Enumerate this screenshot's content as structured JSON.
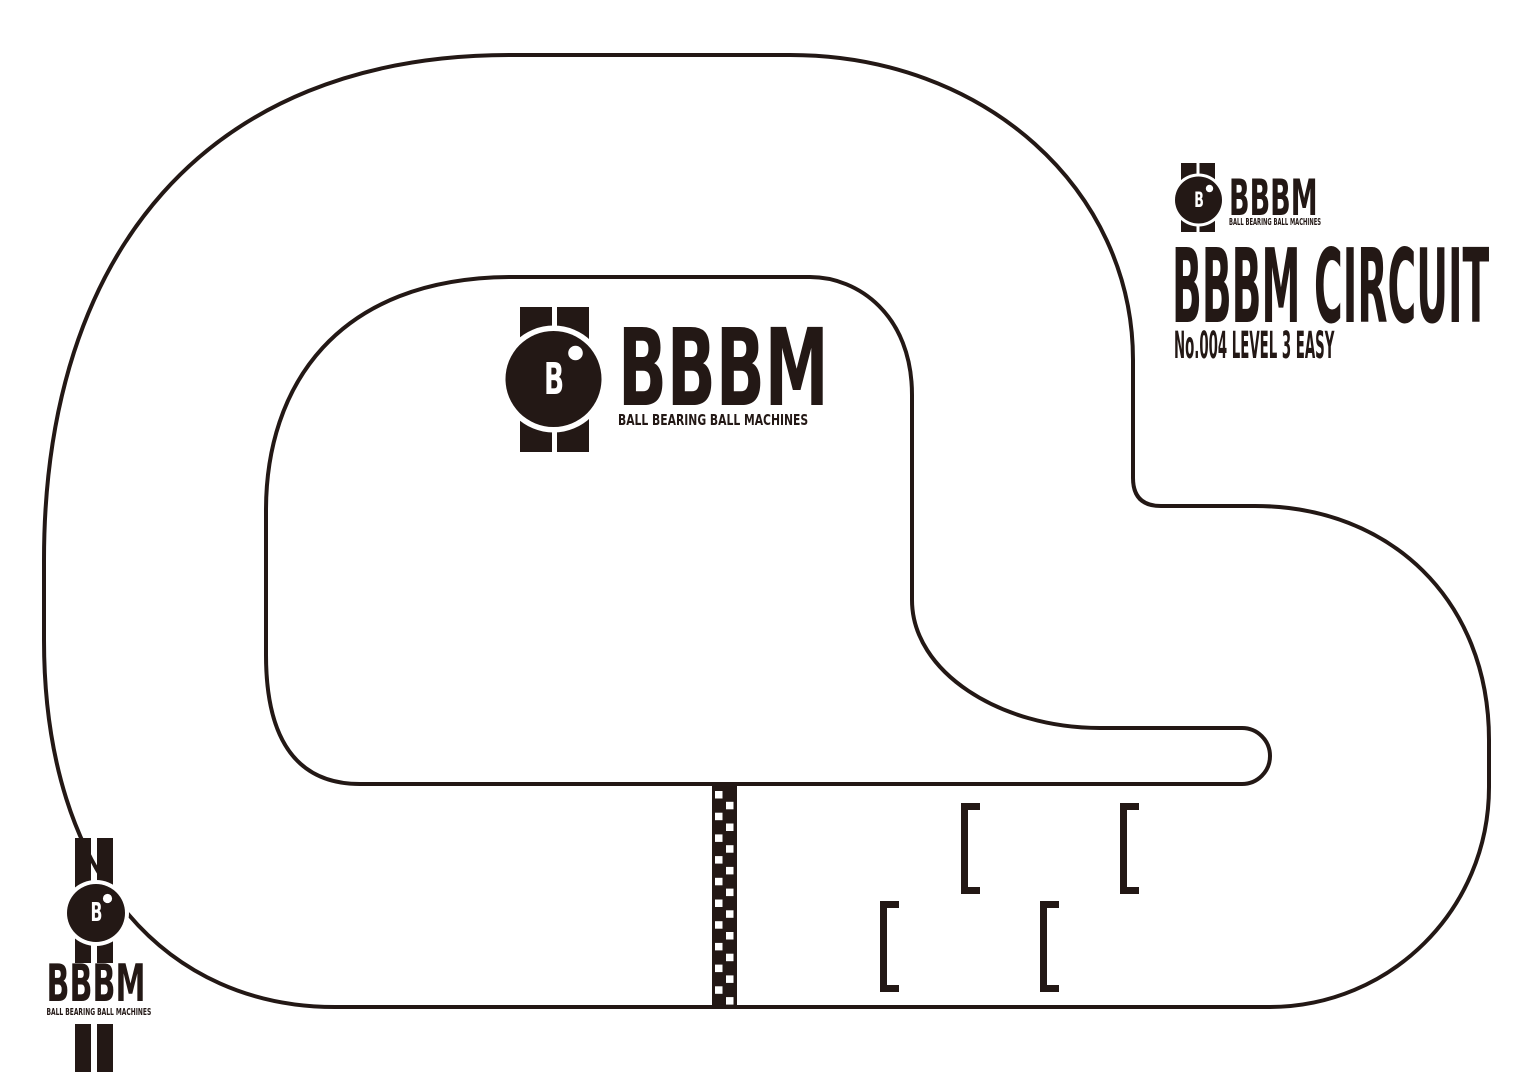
{
  "canvas": {
    "width": 1536,
    "height": 1086,
    "ink": "#231815",
    "paper": "#ffffff"
  },
  "branding": {
    "brand": "BBBM",
    "tagline": "BALL BEARING BALL MACHINES",
    "ball_letter": "B"
  },
  "title_block": {
    "title": "BBBM CIRCUIT",
    "subtitle": "No.004 LEVEL 3 EASY"
  },
  "track": {
    "line_width": 4,
    "outer_path": "M 510,55 L 790,55 C 985,55 1133,190 1133,360 L 1133,478 Q 1133,506 1161,506 L 1255,506 C 1390,506 1489,600 1489,740 L 1489,787 C 1489,910 1390,1007 1269,1007 L 335,1007 C 170,1007 44,880 44,640 L 44,560 C 44,255 205,55 510,55 Z",
    "inner_path": "M 513,277 L 810,277 C 858,277 912,315 912,395 L 912,600 C 912,672 1000,728 1100,728 L 1242,728 A 28,28 0 0 1 1242,784 L 360,784 C 300,784 266,744 266,655 L 266,510 C 266,388 335,277 513,277 Z",
    "start_finish_line": {
      "x": 712,
      "y": 786,
      "width": 25,
      "height": 220,
      "square": 7.5,
      "step": 21.7,
      "col_x": [
        3,
        14
      ],
      "col_y0": [
        5,
        15.8
      ],
      "rows": 10
    },
    "grid_markers": {
      "width": 19,
      "height": 91,
      "thickness": 7,
      "positions": [
        {
          "x": 961,
          "y": 803
        },
        {
          "x": 1120,
          "y": 803
        },
        {
          "x": 880,
          "y": 901
        },
        {
          "x": 1040,
          "y": 901
        }
      ]
    }
  }
}
